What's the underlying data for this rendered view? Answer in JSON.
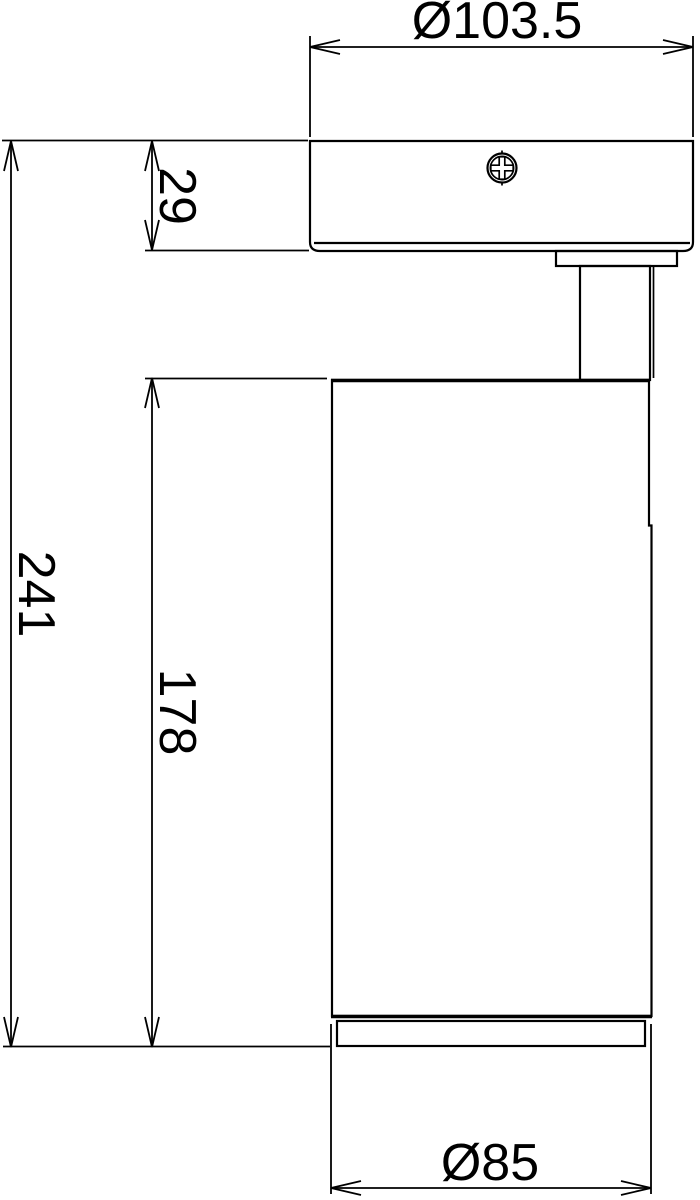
{
  "labels": {
    "diameter_top": "Ø103.5",
    "canopy_height": "29",
    "overall_height": "241",
    "body_height": "178",
    "diameter_bottom": "Ø85"
  },
  "colors": {
    "line": "#000000",
    "background": "#ffffff"
  }
}
